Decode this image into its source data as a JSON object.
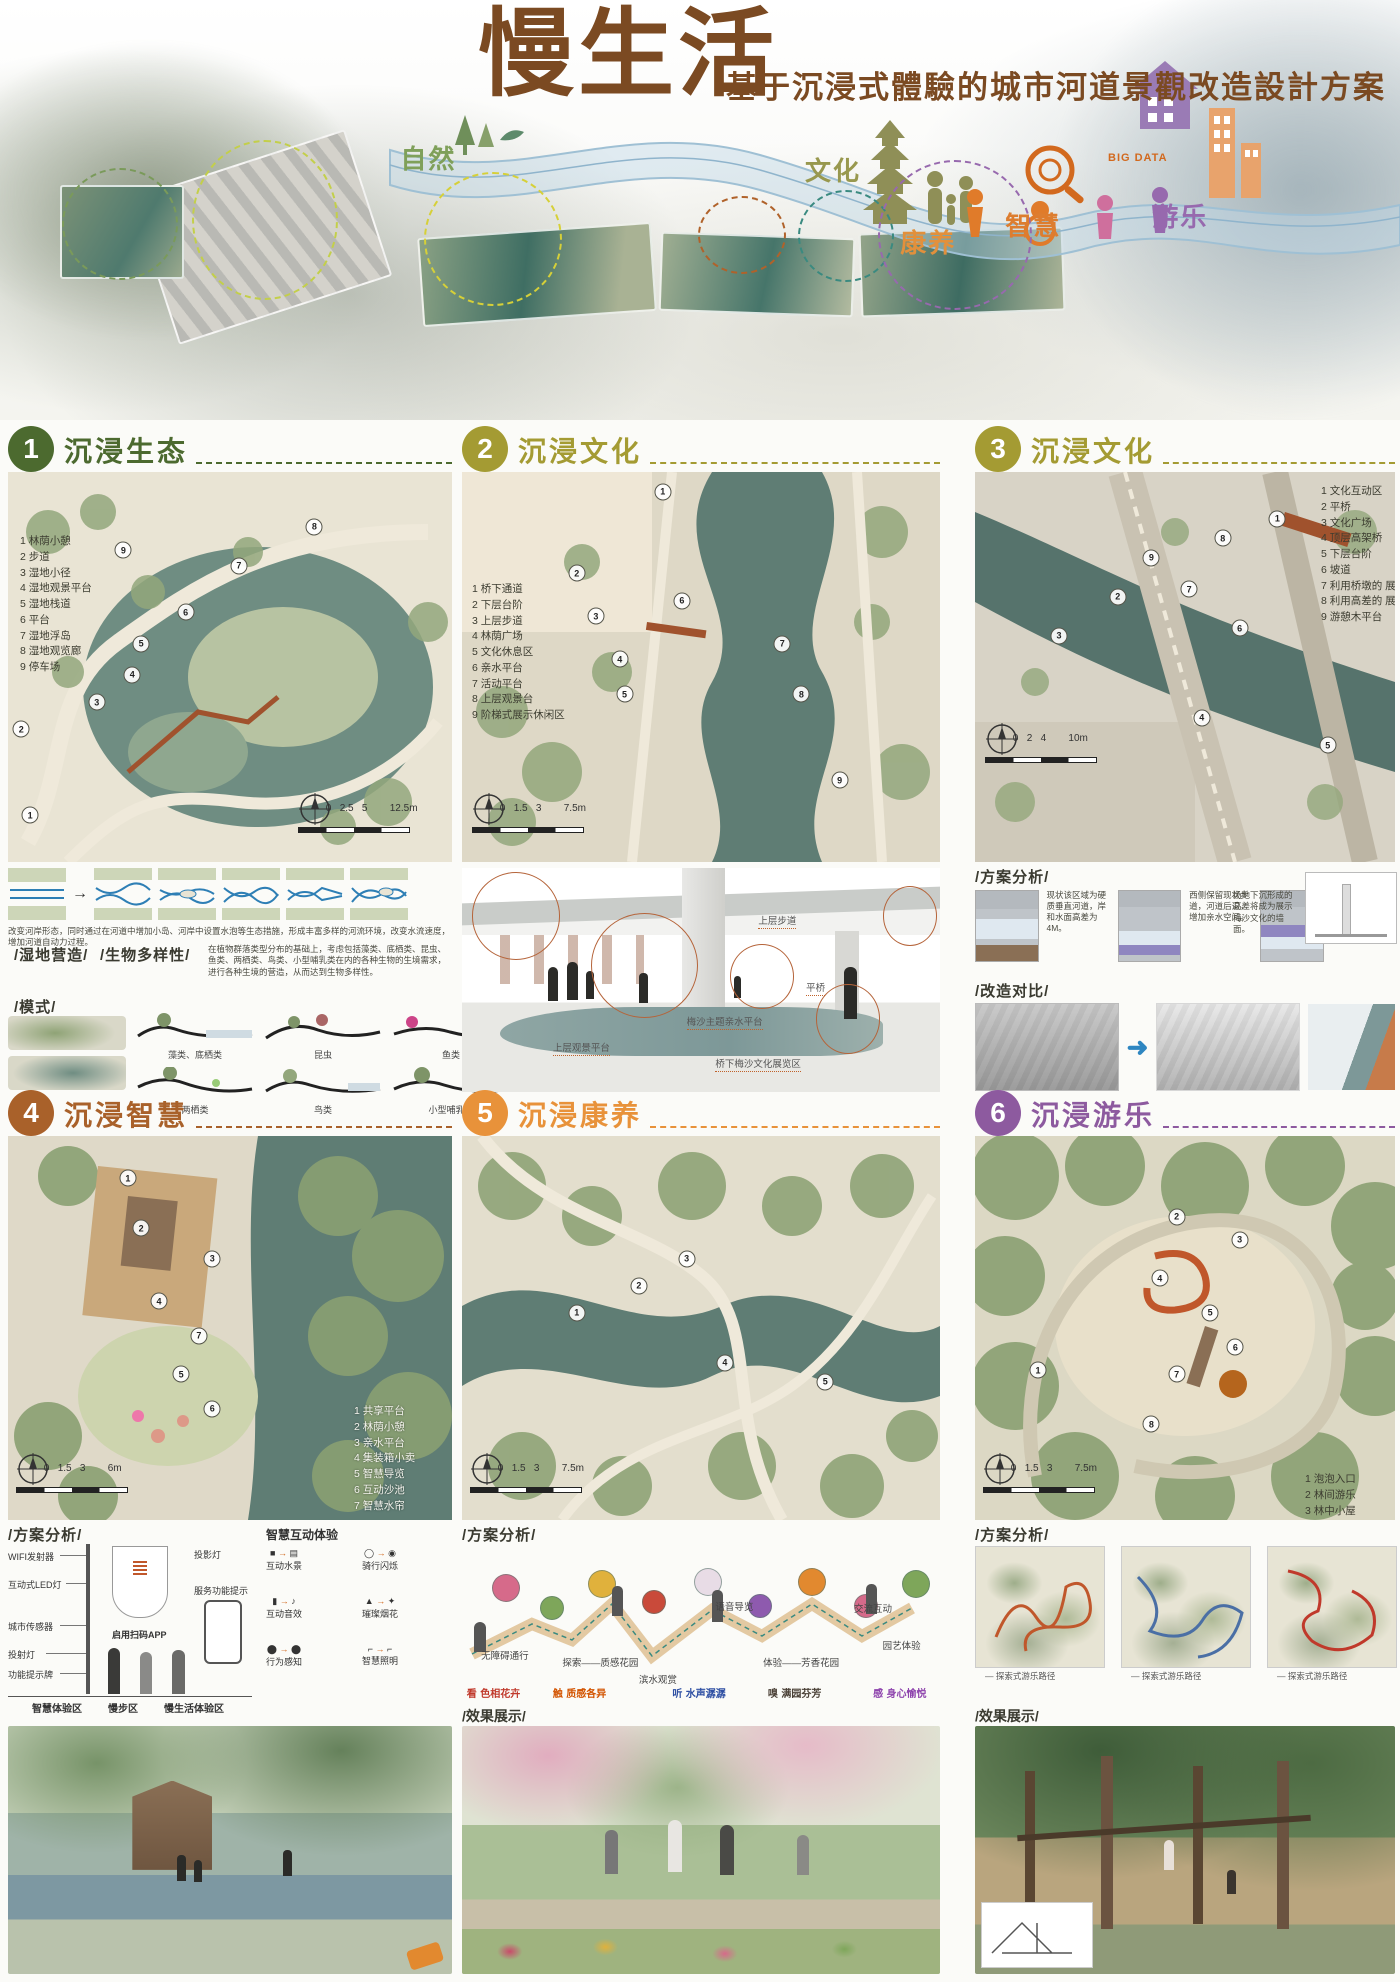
{
  "poster": {
    "title": "慢生活",
    "subtitle": "基于沉浸式體驗的城市河道景觀改造設計方案",
    "banner": {
      "big_data": "BIG DATA",
      "labels": [
        {
          "text": "自然",
          "x": 28.6,
          "y": 33,
          "color": "#7fa05a"
        },
        {
          "text": "文化",
          "x": 57.5,
          "y": 36,
          "color": "#98984e"
        },
        {
          "text": "康养",
          "x": 64.3,
          "y": 53,
          "color": "#e2903c"
        },
        {
          "text": "智慧",
          "x": 71.8,
          "y": 49,
          "color": "#dd7d2f"
        },
        {
          "text": "游乐",
          "x": 82.3,
          "y": 47,
          "color": "#9769ae"
        }
      ]
    }
  },
  "sections": [
    {
      "number": "1",
      "title": "沉浸生态",
      "color": "#4c6a2f",
      "legend": [
        "1 林荫小憩",
        "2 步道",
        "3 湿地小径",
        "4 湿地观景平台",
        "5 湿地栈道",
        "6 平台",
        "7 湿地浮岛",
        "8 湿地观览廊",
        "9 停车场"
      ],
      "scale_ticks": "0   2.5   5",
      "scale_end": "12.5m",
      "markers": [
        {
          "n": "1",
          "x": 5,
          "y": 88
        },
        {
          "n": "2",
          "x": 3,
          "y": 66
        },
        {
          "n": "3",
          "x": 20,
          "y": 59
        },
        {
          "n": "4",
          "x": 28,
          "y": 52
        },
        {
          "n": "5",
          "x": 30,
          "y": 44
        },
        {
          "n": "6",
          "x": 40,
          "y": 36
        },
        {
          "n": "7",
          "x": 52,
          "y": 24
        },
        {
          "n": "8",
          "x": 69,
          "y": 14
        },
        {
          "n": "9",
          "x": 26,
          "y": 20
        }
      ]
    },
    {
      "number": "2",
      "title": "沉浸文化",
      "color": "#a49b33",
      "legend": [
        "1 桥下通道",
        "2 下层台阶",
        "3 上层步道",
        "4 林荫广场",
        "5 文化休息区",
        "6 亲水平台",
        "7 活动平台",
        "8 上层观景台",
        "9 阶梯式展示休闲区"
      ],
      "scale_ticks": "0   1.5   3",
      "scale_end": "7.5m",
      "markers": [
        {
          "n": "1",
          "x": 42,
          "y": 5
        },
        {
          "n": "2",
          "x": 24,
          "y": 26
        },
        {
          "n": "3",
          "x": 28,
          "y": 37
        },
        {
          "n": "4",
          "x": 33,
          "y": 48
        },
        {
          "n": "5",
          "x": 34,
          "y": 57
        },
        {
          "n": "6",
          "x": 46,
          "y": 33
        },
        {
          "n": "7",
          "x": 67,
          "y": 44
        },
        {
          "n": "8",
          "x": 71,
          "y": 57
        },
        {
          "n": "9",
          "x": 79,
          "y": 79
        }
      ]
    },
    {
      "number": "3",
      "title": "沉浸文化",
      "color": "#a49b33",
      "legend": [
        "1 文化互动区",
        "2 平桥",
        "3 文化广场",
        "4 顶层高架桥",
        "5 下层台阶",
        "6 坡道",
        "7 利用桥墩的 展览空间",
        "8 利用高差的 展览空间",
        "9 游憩木平台"
      ],
      "scale_ticks": "0   2   4",
      "scale_end": "10m",
      "markers": [
        {
          "n": "1",
          "x": 72,
          "y": 12
        },
        {
          "n": "2",
          "x": 34,
          "y": 32
        },
        {
          "n": "3",
          "x": 20,
          "y": 42
        },
        {
          "n": "4",
          "x": 54,
          "y": 63
        },
        {
          "n": "5",
          "x": 84,
          "y": 70
        },
        {
          "n": "6",
          "x": 63,
          "y": 40
        },
        {
          "n": "7",
          "x": 51,
          "y": 30
        },
        {
          "n": "8",
          "x": 59,
          "y": 17
        },
        {
          "n": "9",
          "x": 42,
          "y": 22
        }
      ]
    },
    {
      "number": "4",
      "title": "沉浸智慧",
      "color": "#a9612a",
      "legend": [
        "1 共享平台",
        "2 林荫小憩",
        "3 亲水平台",
        "4 集装箱小卖",
        "5 智慧导览",
        "6 互动沙池",
        "7 智慧水帘"
      ],
      "scale_ticks": "0   1.5   3",
      "scale_end": "6m",
      "markers": [
        {
          "n": "1",
          "x": 27,
          "y": 11
        },
        {
          "n": "2",
          "x": 30,
          "y": 24
        },
        {
          "n": "3",
          "x": 46,
          "y": 32
        },
        {
          "n": "4",
          "x": 34,
          "y": 43
        },
        {
          "n": "5",
          "x": 39,
          "y": 62
        },
        {
          "n": "6",
          "x": 46,
          "y": 71
        },
        {
          "n": "7",
          "x": 43,
          "y": 52
        }
      ]
    },
    {
      "number": "5",
      "title": "沉浸康养",
      "color": "#e8923a",
      "legend": [],
      "scale_ticks": "0   1.5   3",
      "scale_end": "7.5m",
      "markers": [
        {
          "n": "1",
          "x": 24,
          "y": 46
        },
        {
          "n": "2",
          "x": 37,
          "y": 39
        },
        {
          "n": "3",
          "x": 47,
          "y": 32
        },
        {
          "n": "4",
          "x": 55,
          "y": 59
        },
        {
          "n": "5",
          "x": 76,
          "y": 64
        }
      ]
    },
    {
      "number": "6",
      "title": "沉浸游乐",
      "color": "#8d5a9f",
      "legend": [
        "1 泡泡入口",
        "2 林间游乐",
        "3 林中小屋",
        "4 竹间憩",
        "5 林中行",
        "6 树根乐园",
        "7 过家家",
        "8 旱喷广场"
      ],
      "scale_ticks": "0   1.5   3",
      "scale_end": "7.5m",
      "markers": [
        {
          "n": "1",
          "x": 15,
          "y": 61
        },
        {
          "n": "2",
          "x": 48,
          "y": 21
        },
        {
          "n": "3",
          "x": 63,
          "y": 27
        },
        {
          "n": "4",
          "x": 44,
          "y": 37
        },
        {
          "n": "5",
          "x": 56,
          "y": 46
        },
        {
          "n": "6",
          "x": 62,
          "y": 55
        },
        {
          "n": "7",
          "x": 48,
          "y": 62
        },
        {
          "n": "8",
          "x": 42,
          "y": 75
        }
      ]
    }
  ],
  "eco": {
    "river_note": "改变河岸形态，同时通过在河道中增加小岛、河岸中设置水泡等生态措施，形成丰富多样的河流环境，改变水流速度，增加河道自动力过程。",
    "wetland_label": "/湿地营造/",
    "biodiversity_label": "/生物多样性/",
    "biodiversity_note": "在植物群落类型分布的基础上，考虑包括藻类、底栖类、昆虫、鱼类、两栖类、鸟类、小型哺乳类在内的各种生物的生境需求，进行各种生境的营造，从而达到生物多样性。",
    "mode_label": "/模式/",
    "mode_items": [
      "藻类、底栖类",
      "昆虫",
      "鱼类",
      "两栖类",
      "鸟类",
      "小型哺乳类"
    ]
  },
  "culture_render": {
    "labels": [
      {
        "text": "上层步道",
        "x": 62,
        "y": 20
      },
      {
        "text": "平桥",
        "x": 72,
        "y": 50
      },
      {
        "text": "梅沙主题亲水平台",
        "x": 47,
        "y": 65
      },
      {
        "text": "上层观景平台",
        "x": 19,
        "y": 77
      },
      {
        "text": "桥下梅沙文化展览区",
        "x": 53,
        "y": 84
      }
    ]
  },
  "culture3": {
    "analysis_label": "/方案分析/",
    "notes": [
      "现状该区域为硬质垂直河道，岸和水面高差为 4M。",
      "西侧保留现状步道，河道后退，增加亲水空间。",
      "东侧河岸后退，在保证上层通行的基础上，扩大下层亲水空间。"
    ],
    "wall_note": "场地下沉形成的高差将成为展示梅沙文化的墙面。",
    "compare_label": "/改造对比/"
  },
  "smart": {
    "analysis_label": "/方案分析/",
    "pole_left": [
      "WIFI发射器",
      "互动式LED灯",
      "城市传感器",
      "投射灯",
      "功能提示牌"
    ],
    "pole_right": [
      "投影灯",
      "服务功能提示"
    ],
    "pole_center": "启用扫码APP",
    "zones": [
      "智慧体验区",
      "慢步区",
      "慢生活体验区"
    ],
    "interact_title": "智慧互动体验",
    "interact_items": [
      "互动水景",
      "互动音效",
      "骑行闪烁",
      "璀璨烟花",
      "智慧照明",
      "行为感知"
    ]
  },
  "health": {
    "analysis_label": "/方案分析/",
    "path_labels": [
      {
        "text": "无障碍通行",
        "x": 4,
        "y": 62
      },
      {
        "text": "探索——质感花园",
        "x": 21,
        "y": 66
      },
      {
        "text": "滨水观赏",
        "x": 37,
        "y": 76
      },
      {
        "text": "语音导览",
        "x": 53,
        "y": 33
      },
      {
        "text": "体验——芳香花园",
        "x": 63,
        "y": 66
      },
      {
        "text": "交流互动",
        "x": 82,
        "y": 34
      },
      {
        "text": "园艺体验",
        "x": 88,
        "y": 56
      }
    ],
    "senses": [
      {
        "text": "看  色相花卉",
        "x": 1,
        "y": 84,
        "color": "#c0392b"
      },
      {
        "text": "触  质感各异",
        "x": 19,
        "y": 84,
        "color": "#d35400"
      },
      {
        "text": "听  水声潺潺",
        "x": 44,
        "y": 84,
        "color": "#2e4fa3"
      },
      {
        "text": "嗅  满园芬芳",
        "x": 64,
        "y": 84,
        "color": "#4a4036"
      },
      {
        "text": "感  身心愉悦",
        "x": 86,
        "y": 84,
        "color": "#8e44ad"
      }
    ]
  },
  "play": {
    "analysis_label": "/方案分析/",
    "captions": [
      "— 探索式游乐路径",
      "— 探索式游乐路径",
      "— 探索式游乐路径"
    ]
  },
  "effects": {
    "label_health": "/效果展示/",
    "label_play": "/效果展示/"
  }
}
